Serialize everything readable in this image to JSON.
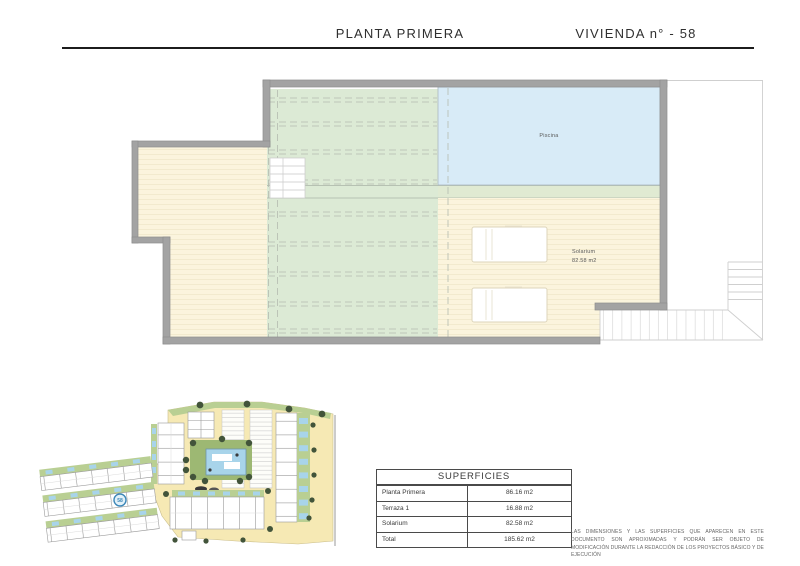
{
  "header": {
    "left_title": "PLANTA PRIMERA",
    "right_title": "VIVIENDA n° - 58"
  },
  "floor_plan": {
    "labels": {
      "pool": "Piscina",
      "solarium_name": "Solarium",
      "solarium_area": "82.58 m2"
    }
  },
  "site_plan": {
    "marker_label": "58"
  },
  "table": {
    "title": "SUPERFICIES",
    "rows": [
      {
        "label": "Planta Primera",
        "value": "86.16 m2"
      },
      {
        "label": "Terraza 1",
        "value": "16.88 m2"
      },
      {
        "label": "Solarium",
        "value": "82.58 m2"
      },
      {
        "label": "Total",
        "value": "185.62 m2"
      }
    ]
  },
  "disclaimer": "LAS DIMENSIONES Y LAS SUPERFICIES QUE APARECEN EN ESTE DOCUMENTO SON APROXIMADAS Y PODRÁN SER OBJETO DE MODIFICACIÓN DURANTE LA REDACCIÓN DE LOS PROYECTOS BÁSICO Y DE EJECUCIÓN",
  "palette": {
    "wall": "#a3a3a3",
    "wall_edge": "#8d8d8d",
    "terrace_cream": "#fbf4dd",
    "deck_line": "#f0e7cb",
    "pergola_green": "#dcead5",
    "pool_blue": "#d8ebf7",
    "strip_green": "#e0ead2",
    "dash_gray": "#b4bbb0",
    "thin_line": "#cfcfcf",
    "site_cream": "#f6e9b4",
    "site_green": "#b9cf93",
    "island_green": "#9db873",
    "site_pool_blue": "#a8d4ea",
    "tree_green": "#42543a",
    "marker_blue": "#3c87b8",
    "text_dark": "#2f2f2f",
    "text_gray": "#5a5a5a",
    "table_border": "#4a4a4a"
  }
}
